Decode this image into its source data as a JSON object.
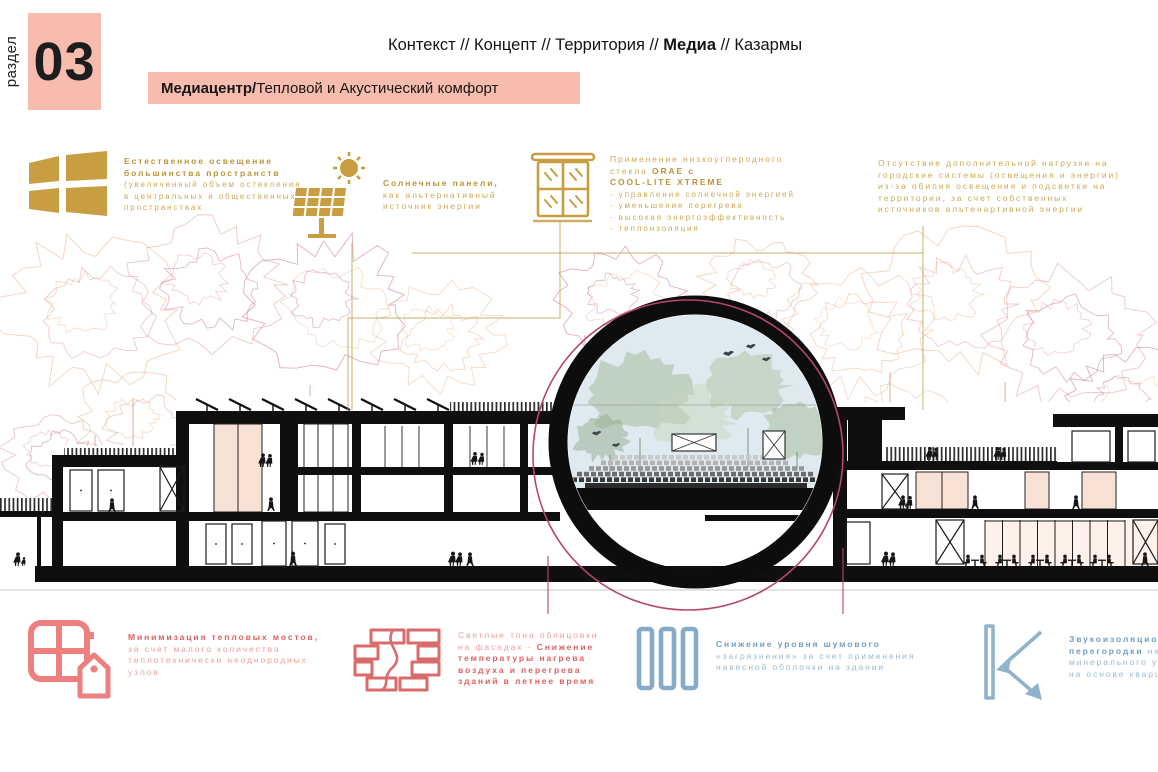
{
  "section": {
    "label": "раздел",
    "number": "03"
  },
  "breadcrumb": {
    "pre": "Контекст // Концепт // Территория  // ",
    "active": "Медиа",
    "post": "  // Казармы"
  },
  "title": {
    "bold": "Медиацентр/",
    "rest": "Тепловой и Акустический комфорт"
  },
  "colors": {
    "accent_pink": "#f8bcae",
    "gold": "#c99d42",
    "red": "#e25f5f",
    "red_light": "#ef9d9d",
    "blue": "#6f9fc3",
    "blue_light": "#9ab9d1",
    "circle_pink": "#b5476b",
    "ink": "#111111"
  },
  "top_blocks": [
    {
      "icon": "window-solid-icon",
      "title_line1": "Естественное освещение",
      "title_line2": "большинства пространств",
      "body_lines": [
        "(увеличенный объем остекления",
        "в центральных и общественных",
        "пространствах"
      ]
    },
    {
      "icon": "solar-panel-icon",
      "title_line1": "Солнечные панели,",
      "body_lines": [
        "как альтернативный",
        "источник энергии"
      ]
    },
    {
      "icon": "glass-window-icon",
      "line1": "Применение низкоуглеродного",
      "line2_pre": "стекла  ",
      "line2_bold": "ORAE с",
      "line3_bold": "COOL-LITE XTREME",
      "bullets": [
        "- управление солнечной энергией",
        "- уменьшение перегрева",
        "- высокая энергоэффективность",
        "- теплоизоляция"
      ]
    },
    {
      "lines": [
        "Отсутствие дополнительной нагрузки на",
        "городские системы (освещения и энергии)",
        "из-за обилия освещения и подсветки на",
        "территории, за счет собственных",
        "источников альтенартивной энергии"
      ]
    }
  ],
  "bottom_blocks": [
    {
      "icon": "window-house-icon",
      "title": "Минимизация тепловых мостов,",
      "body_lines": [
        "за счет малого количества",
        "теплотехнически неоднородных",
        "узлов"
      ]
    },
    {
      "icon": "brick-wall-icon",
      "line1": "Светлые тона облицовки",
      "line2_pre": "на фасадах - ",
      "line2_bold": "Снижение",
      "bold_lines": [
        "температуры нагрева",
        "воздуха и перегрева",
        "зданий в летнее время"
      ]
    },
    {
      "icon": "acoustic-panels-icon",
      "title": "Снижение уровня шумового",
      "body_lines": [
        "«загрязнения» за счет применения",
        "навесной оболочки на здании"
      ]
    },
    {
      "icon": "sound-insulation-icon",
      "title": "Звукоизоляционные",
      "line2_bold": "перегородки",
      "line2_rest": " на ос",
      "body_lines": [
        "минерального утепл",
        "на основе кварца"
      ]
    }
  ]
}
